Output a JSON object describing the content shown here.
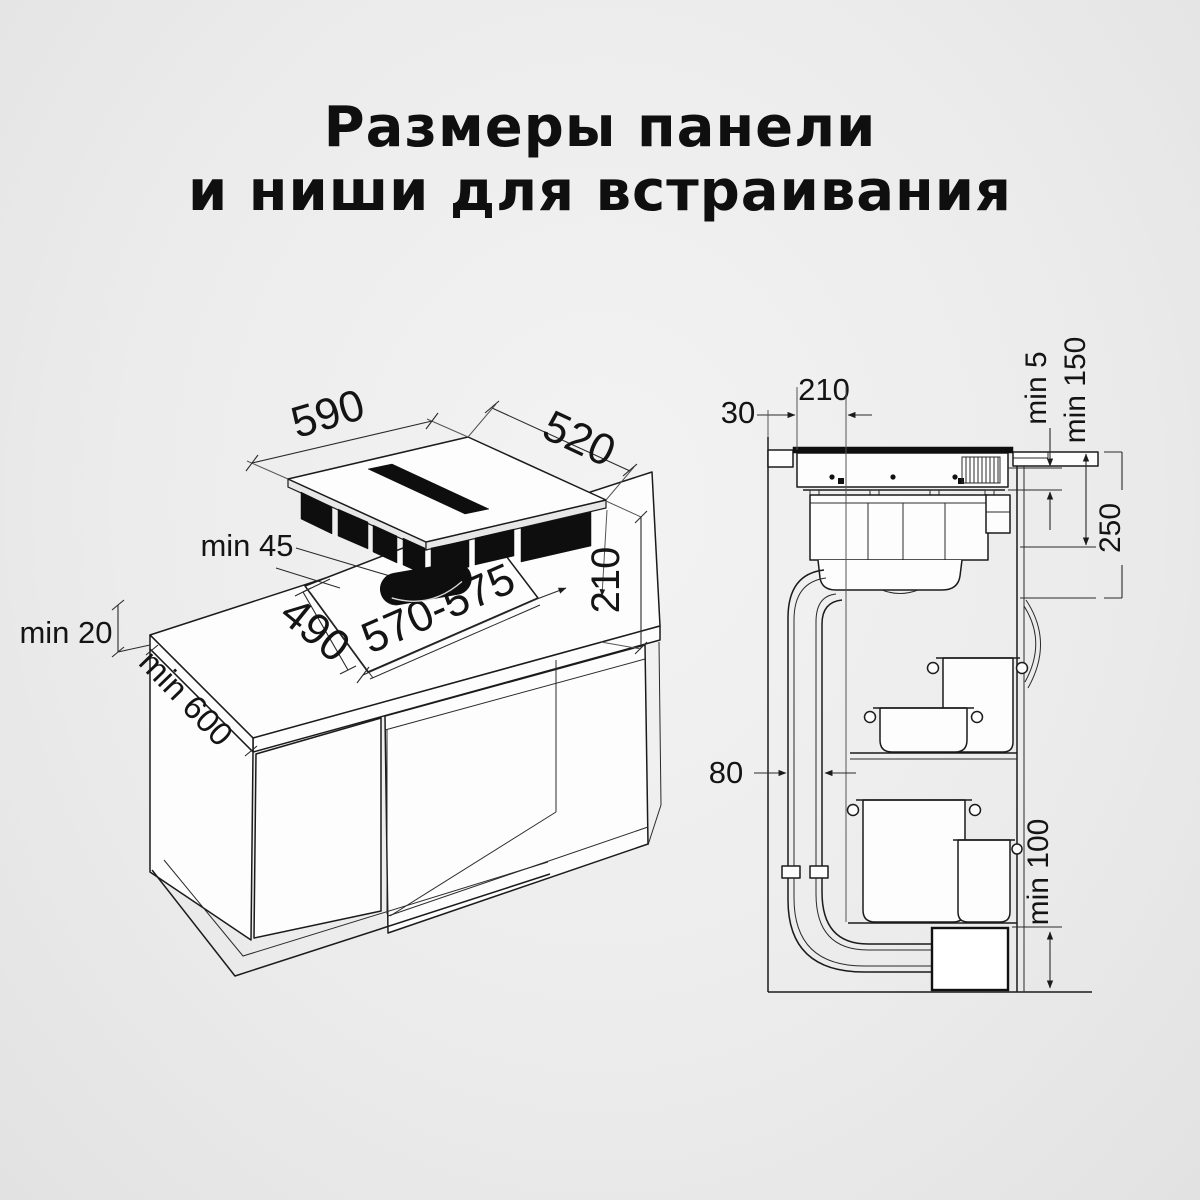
{
  "title": {
    "line1": "Размеры панели",
    "line2": "и ниши для встраивания"
  },
  "colors": {
    "background": "#ececec",
    "line": "#1b1b1b"
  },
  "left_diagram": {
    "panel_width": "590",
    "panel_depth": "520",
    "panel_height": "210",
    "cutout_front_min": "min 45",
    "cutout_depth": "490",
    "cutout_width": "570-575",
    "worktop_min_thickness": "min 20",
    "worktop_min_depth": "min 600"
  },
  "right_diagram": {
    "wall_clearance": "30",
    "duct_offset": "210",
    "glass_overhang_min": "min 5",
    "clearance_min_150": "min 150",
    "clearance_250": "250",
    "duct_width": "80",
    "plinth_min_height": "min 100"
  }
}
